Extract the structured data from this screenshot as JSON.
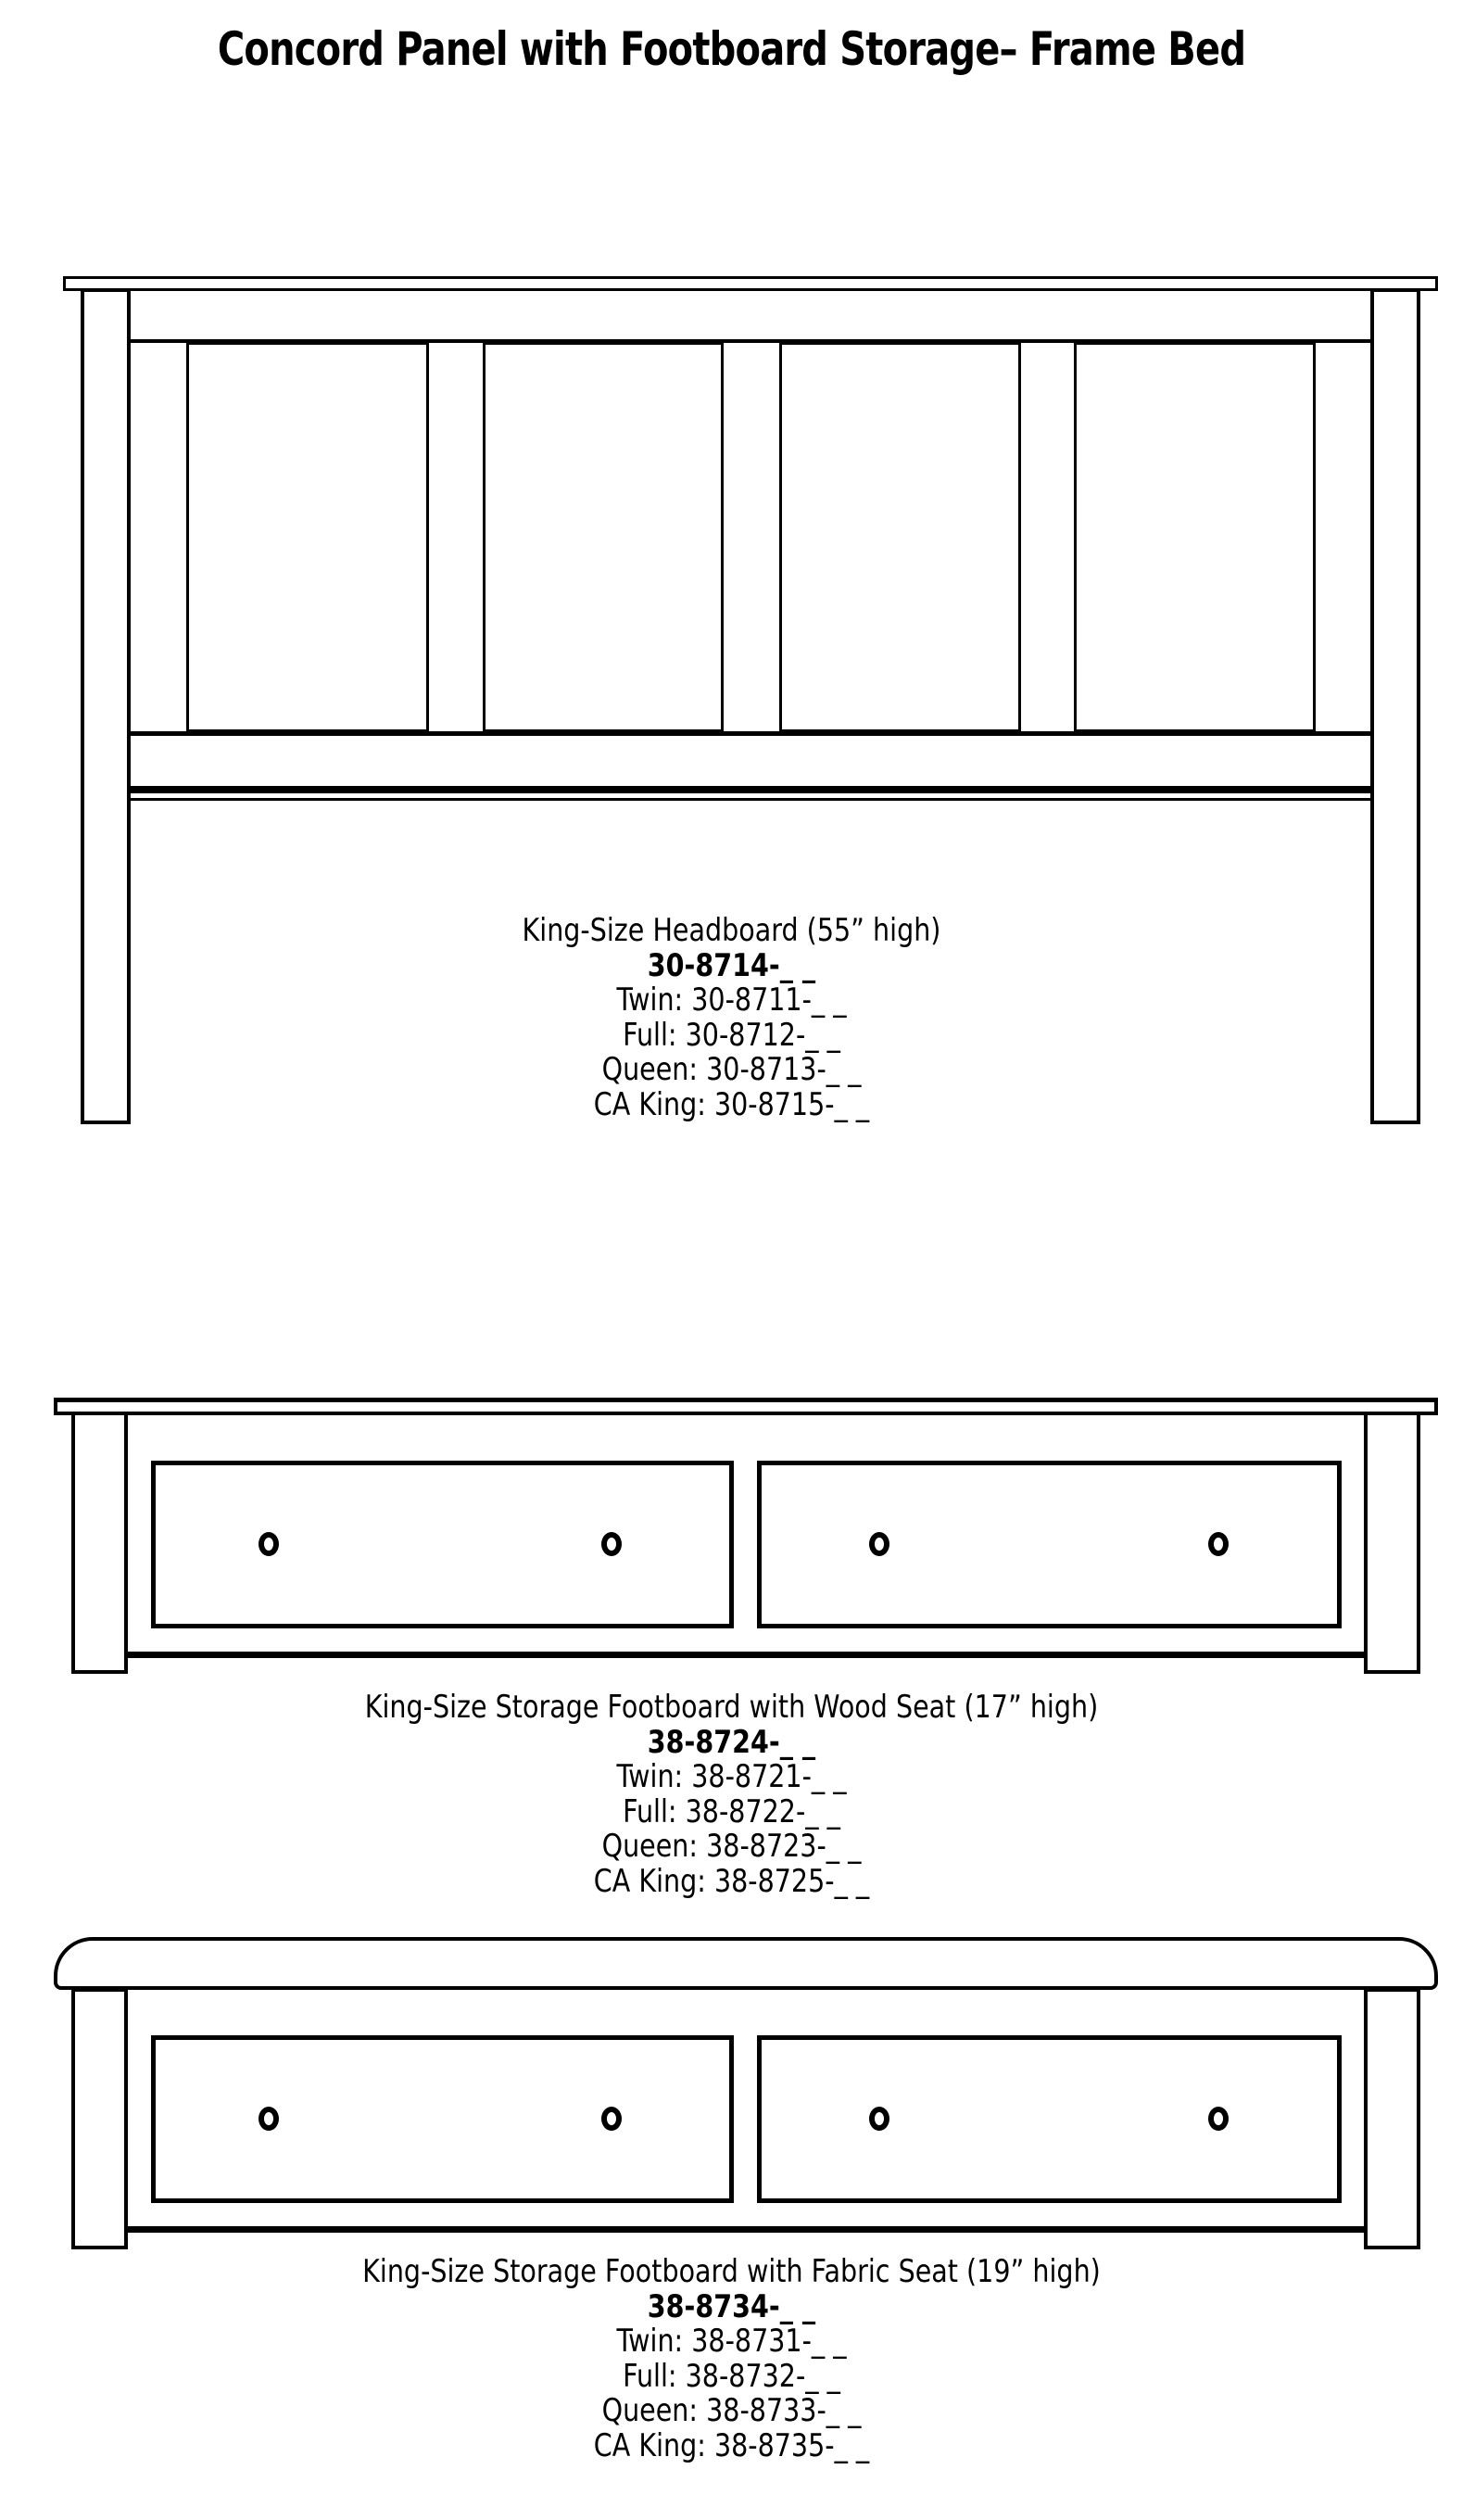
{
  "page": {
    "title": "Concord Panel with Footboard Storage– Frame Bed",
    "background_color": "#ffffff",
    "line_color": "#000000"
  },
  "products": [
    {
      "id": "headboard",
      "caption": "King-Size Headboard (55” high)",
      "main_code": "30-8714-_ _",
      "variants": [
        {
          "label": "Twin:",
          "code": "30-8711-_ _"
        },
        {
          "label": "Full:",
          "code": "30-8712-_ _"
        },
        {
          "label": "Queen:",
          "code": "30-8713-_ _"
        },
        {
          "label": "CA King:",
          "code": "30-8715-_ _"
        }
      ]
    },
    {
      "id": "storage-footboard-wood-seat",
      "caption": "King-Size Storage Footboard with Wood Seat (17” high)",
      "main_code": "38-8724-_ _",
      "variants": [
        {
          "label": "Twin:",
          "code": "38-8721-_ _"
        },
        {
          "label": "Full:",
          "code": "38-8722-_ _"
        },
        {
          "label": "Queen:",
          "code": "38-8723-_ _"
        },
        {
          "label": "CA King:",
          "code": "38-8725-_ _"
        }
      ]
    },
    {
      "id": "storage-footboard-fabric-seat",
      "caption": "King-Size Storage Footboard with Fabric Seat (19” high)",
      "main_code": "38-8734-_ _",
      "variants": [
        {
          "label": "Twin:",
          "code": "38-8731-_ _"
        },
        {
          "label": "Full:",
          "code": "38-8732-_ _"
        },
        {
          "label": "Queen:",
          "code": "38-8733-_ _"
        },
        {
          "label": "CA King:",
          "code": "38-8735-_ _"
        }
      ]
    }
  ]
}
